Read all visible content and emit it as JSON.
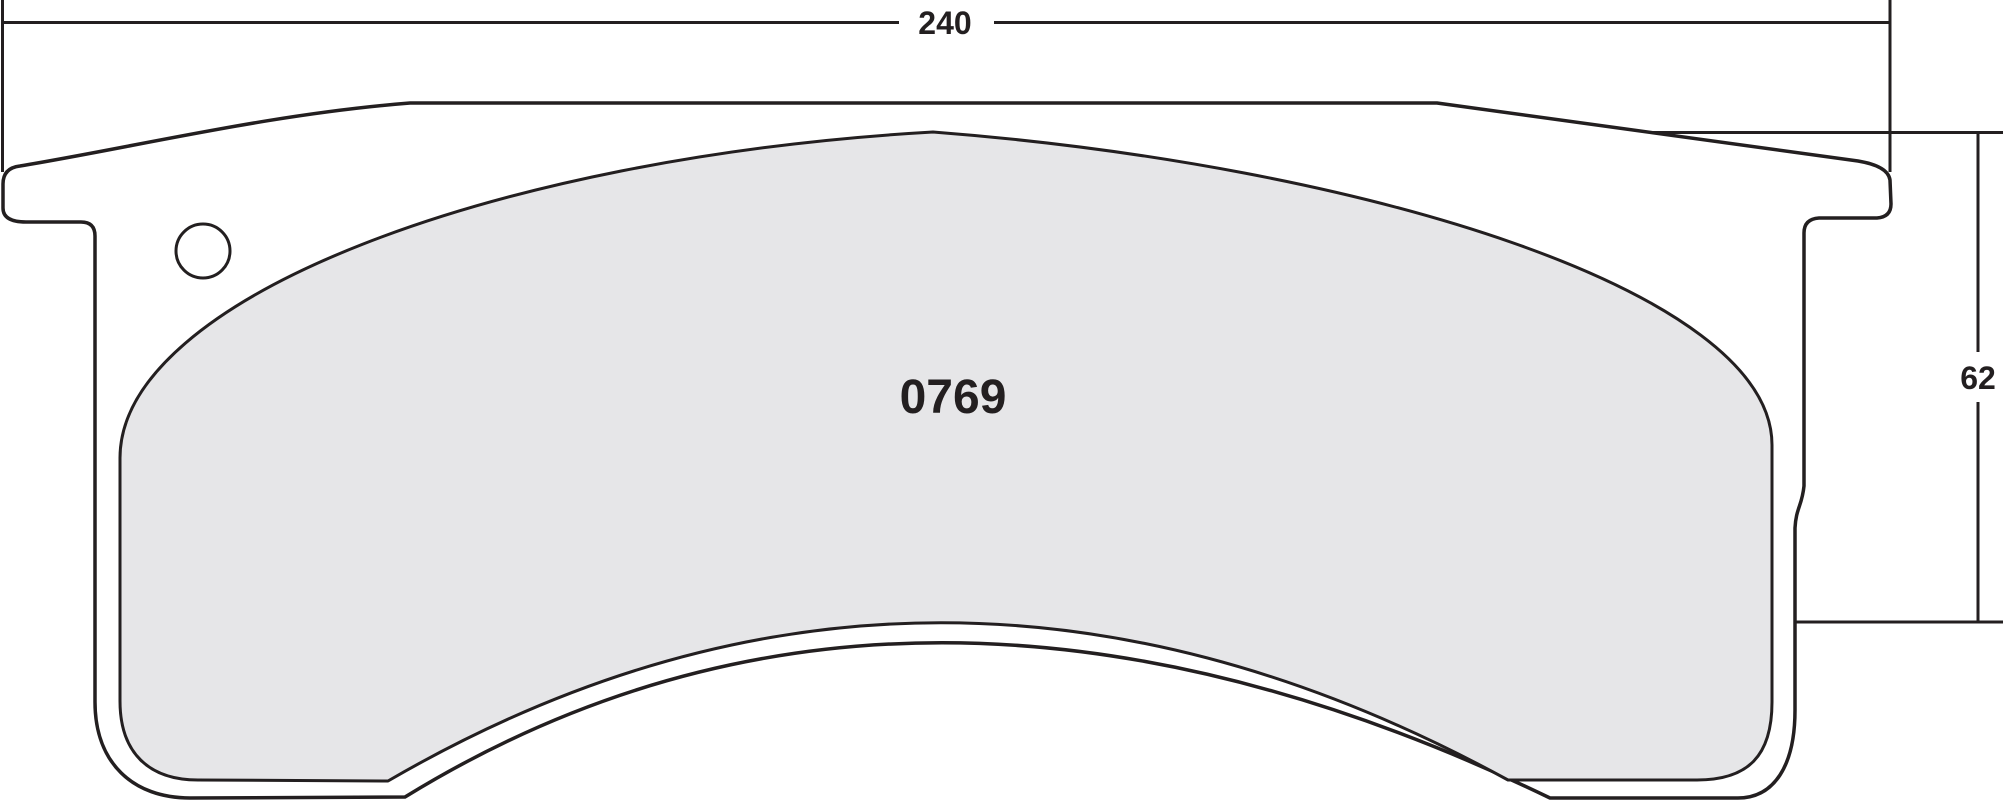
{
  "drawing": {
    "part_number": "0769",
    "dimensions": {
      "width": "240",
      "height": "62"
    },
    "colors": {
      "line": "#231f20",
      "friction_fill": "#e6e6e8",
      "plate_fill": "#ffffff",
      "background": "#ffffff"
    }
  }
}
